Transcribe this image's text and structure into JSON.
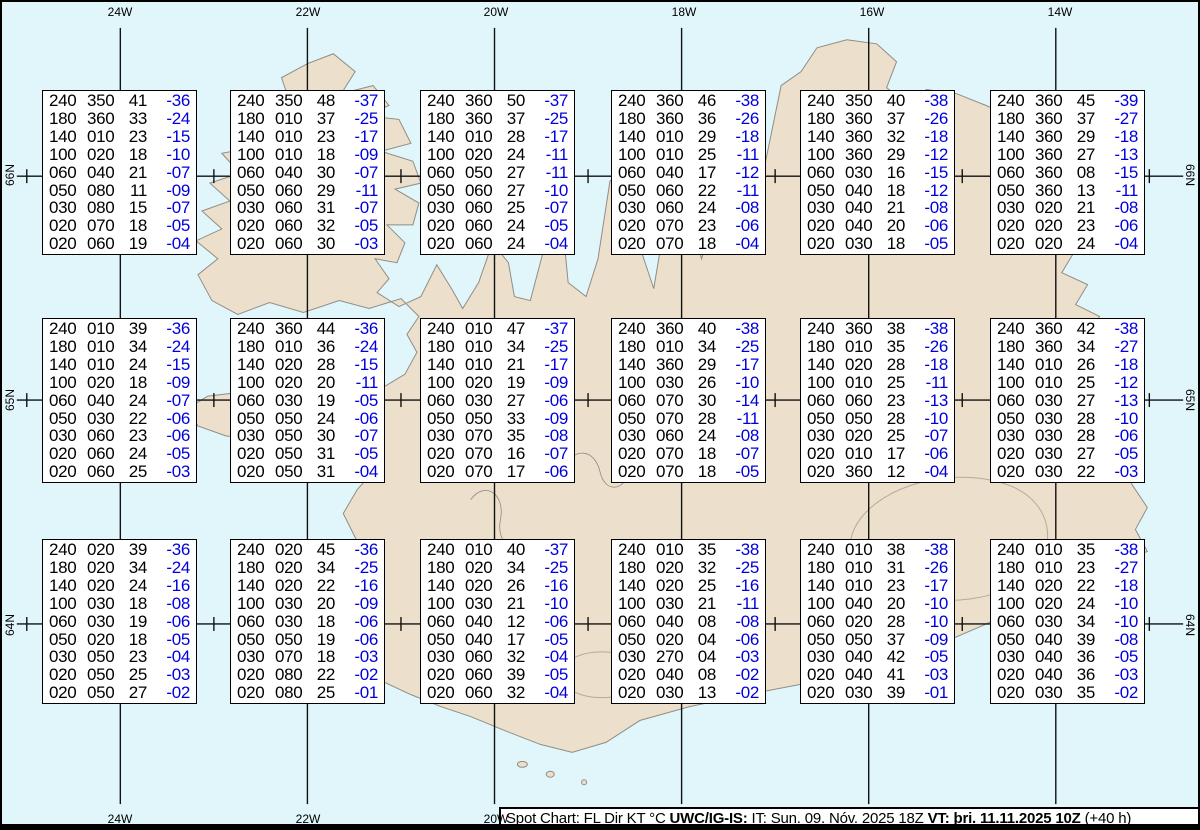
{
  "colors": {
    "ocean": "#e1f6fb",
    "land": "#ecdfcb",
    "coast": "#8f8d86",
    "glacier": "#b3ab9b",
    "temp": "#0000dd",
    "grid": "#111111",
    "boxborder": "#000000"
  },
  "grid": {
    "lon_labels": [
      "24W",
      "22W",
      "20W",
      "18W",
      "16W",
      "14W"
    ],
    "lon_x": [
      118,
      306,
      494,
      682,
      870,
      1058
    ],
    "bottom_labels_visible": 3,
    "lat_labels": [
      "66N",
      "65N",
      "64N"
    ],
    "lat_y": [
      175,
      400,
      625
    ],
    "tick_x": [
      24,
      212,
      400,
      588,
      776,
      964,
      1152
    ]
  },
  "caption": {
    "segments": [
      {
        "text": "Spot Chart: FL Dir KT °C ",
        "bold": false
      },
      {
        "text": "UWC/IG-IS:",
        "bold": true
      },
      {
        "text": " IT: Sun. 09. Nóv. 2025 18Z ",
        "bold": false
      },
      {
        "text": "VT: þri. 11.11.2025 10Z",
        "bold": true
      },
      {
        "text": " (+40 h)",
        "bold": false
      }
    ]
  },
  "columns": [
    "FL",
    "Dir",
    "KT",
    "°C"
  ],
  "layout": {
    "col_x": [
      40,
      228,
      418,
      609,
      798,
      988
    ],
    "row_y": [
      88,
      316,
      537
    ],
    "box_w": 155,
    "box_h": 165
  },
  "spot_boxes": [
    {
      "rows": [
        [
          "240",
          "350",
          "41",
          "-36"
        ],
        [
          "180",
          "360",
          "33",
          "-24"
        ],
        [
          "140",
          "010",
          "23",
          "-15"
        ],
        [
          "100",
          "020",
          "18",
          "-10"
        ],
        [
          "060",
          "040",
          "21",
          "-07"
        ],
        [
          "050",
          "080",
          "11",
          "-09"
        ],
        [
          "030",
          "080",
          "15",
          "-07"
        ],
        [
          "020",
          "070",
          "18",
          "-05"
        ],
        [
          "020",
          "060",
          "19",
          "-04"
        ]
      ]
    },
    {
      "rows": [
        [
          "240",
          "350",
          "48",
          "-37"
        ],
        [
          "180",
          "010",
          "37",
          "-25"
        ],
        [
          "140",
          "010",
          "23",
          "-17"
        ],
        [
          "100",
          "010",
          "18",
          "-09"
        ],
        [
          "060",
          "040",
          "30",
          "-07"
        ],
        [
          "050",
          "060",
          "29",
          "-11"
        ],
        [
          "030",
          "060",
          "31",
          "-07"
        ],
        [
          "020",
          "060",
          "32",
          "-05"
        ],
        [
          "020",
          "060",
          "30",
          "-03"
        ]
      ]
    },
    {
      "rows": [
        [
          "240",
          "360",
          "50",
          "-37"
        ],
        [
          "180",
          "360",
          "37",
          "-25"
        ],
        [
          "140",
          "010",
          "28",
          "-17"
        ],
        [
          "100",
          "020",
          "24",
          "-11"
        ],
        [
          "060",
          "050",
          "27",
          "-11"
        ],
        [
          "050",
          "060",
          "27",
          "-10"
        ],
        [
          "030",
          "060",
          "25",
          "-07"
        ],
        [
          "020",
          "060",
          "24",
          "-05"
        ],
        [
          "020",
          "060",
          "24",
          "-04"
        ]
      ]
    },
    {
      "rows": [
        [
          "240",
          "360",
          "46",
          "-38"
        ],
        [
          "180",
          "360",
          "36",
          "-26"
        ],
        [
          "140",
          "010",
          "29",
          "-18"
        ],
        [
          "100",
          "010",
          "25",
          "-11"
        ],
        [
          "060",
          "040",
          "17",
          "-12"
        ],
        [
          "050",
          "060",
          "22",
          "-11"
        ],
        [
          "030",
          "060",
          "24",
          "-08"
        ],
        [
          "020",
          "070",
          "23",
          "-06"
        ],
        [
          "020",
          "070",
          "18",
          "-04"
        ]
      ]
    },
    {
      "rows": [
        [
          "240",
          "350",
          "40",
          "-38"
        ],
        [
          "180",
          "360",
          "37",
          "-26"
        ],
        [
          "140",
          "360",
          "32",
          "-18"
        ],
        [
          "100",
          "360",
          "29",
          "-12"
        ],
        [
          "060",
          "030",
          "16",
          "-15"
        ],
        [
          "050",
          "040",
          "18",
          "-12"
        ],
        [
          "030",
          "040",
          "21",
          "-08"
        ],
        [
          "020",
          "040",
          "20",
          "-06"
        ],
        [
          "020",
          "030",
          "18",
          "-05"
        ]
      ]
    },
    {
      "rows": [
        [
          "240",
          "360",
          "45",
          "-39"
        ],
        [
          "180",
          "360",
          "37",
          "-27"
        ],
        [
          "140",
          "360",
          "29",
          "-18"
        ],
        [
          "100",
          "360",
          "27",
          "-13"
        ],
        [
          "060",
          "360",
          "08",
          "-15"
        ],
        [
          "050",
          "360",
          "13",
          "-11"
        ],
        [
          "030",
          "020",
          "21",
          "-08"
        ],
        [
          "020",
          "020",
          "23",
          "-06"
        ],
        [
          "020",
          "020",
          "24",
          "-04"
        ]
      ]
    },
    {
      "rows": [
        [
          "240",
          "010",
          "39",
          "-36"
        ],
        [
          "180",
          "010",
          "34",
          "-24"
        ],
        [
          "140",
          "010",
          "24",
          "-15"
        ],
        [
          "100",
          "020",
          "18",
          "-09"
        ],
        [
          "060",
          "040",
          "24",
          "-07"
        ],
        [
          "050",
          "030",
          "22",
          "-06"
        ],
        [
          "030",
          "060",
          "23",
          "-06"
        ],
        [
          "020",
          "060",
          "24",
          "-05"
        ],
        [
          "020",
          "060",
          "25",
          "-03"
        ]
      ]
    },
    {
      "rows": [
        [
          "240",
          "360",
          "44",
          "-36"
        ],
        [
          "180",
          "010",
          "36",
          "-24"
        ],
        [
          "140",
          "020",
          "28",
          "-15"
        ],
        [
          "100",
          "020",
          "20",
          "-11"
        ],
        [
          "060",
          "030",
          "19",
          "-05"
        ],
        [
          "050",
          "050",
          "24",
          "-06"
        ],
        [
          "030",
          "050",
          "30",
          "-07"
        ],
        [
          "020",
          "050",
          "31",
          "-05"
        ],
        [
          "020",
          "050",
          "31",
          "-04"
        ]
      ]
    },
    {
      "rows": [
        [
          "240",
          "010",
          "47",
          "-37"
        ],
        [
          "180",
          "010",
          "34",
          "-25"
        ],
        [
          "140",
          "010",
          "21",
          "-17"
        ],
        [
          "100",
          "020",
          "19",
          "-09"
        ],
        [
          "060",
          "030",
          "27",
          "-06"
        ],
        [
          "050",
          "050",
          "33",
          "-09"
        ],
        [
          "030",
          "070",
          "35",
          "-08"
        ],
        [
          "020",
          "070",
          "16",
          "-07"
        ],
        [
          "020",
          "070",
          "17",
          "-06"
        ]
      ]
    },
    {
      "rows": [
        [
          "240",
          "360",
          "40",
          "-38"
        ],
        [
          "180",
          "010",
          "34",
          "-25"
        ],
        [
          "140",
          "360",
          "29",
          "-17"
        ],
        [
          "100",
          "030",
          "26",
          "-10"
        ],
        [
          "060",
          "070",
          "30",
          "-14"
        ],
        [
          "050",
          "070",
          "28",
          "-11"
        ],
        [
          "030",
          "060",
          "24",
          "-08"
        ],
        [
          "020",
          "070",
          "18",
          "-07"
        ],
        [
          "020",
          "070",
          "18",
          "-05"
        ]
      ]
    },
    {
      "rows": [
        [
          "240",
          "360",
          "38",
          "-38"
        ],
        [
          "180",
          "010",
          "35",
          "-26"
        ],
        [
          "140",
          "020",
          "28",
          "-18"
        ],
        [
          "100",
          "010",
          "25",
          "-11"
        ],
        [
          "060",
          "060",
          "23",
          "-13"
        ],
        [
          "050",
          "050",
          "28",
          "-10"
        ],
        [
          "030",
          "020",
          "25",
          "-07"
        ],
        [
          "020",
          "010",
          "17",
          "-06"
        ],
        [
          "020",
          "360",
          "12",
          "-04"
        ]
      ]
    },
    {
      "rows": [
        [
          "240",
          "360",
          "42",
          "-38"
        ],
        [
          "180",
          "360",
          "34",
          "-27"
        ],
        [
          "140",
          "010",
          "26",
          "-18"
        ],
        [
          "100",
          "010",
          "25",
          "-12"
        ],
        [
          "060",
          "030",
          "27",
          "-13"
        ],
        [
          "050",
          "030",
          "28",
          "-10"
        ],
        [
          "030",
          "030",
          "28",
          "-06"
        ],
        [
          "020",
          "030",
          "27",
          "-05"
        ],
        [
          "020",
          "030",
          "22",
          "-03"
        ]
      ]
    },
    {
      "rows": [
        [
          "240",
          "020",
          "39",
          "-36"
        ],
        [
          "180",
          "020",
          "34",
          "-24"
        ],
        [
          "140",
          "020",
          "24",
          "-16"
        ],
        [
          "100",
          "030",
          "18",
          "-08"
        ],
        [
          "060",
          "030",
          "19",
          "-06"
        ],
        [
          "050",
          "020",
          "18",
          "-05"
        ],
        [
          "030",
          "050",
          "23",
          "-04"
        ],
        [
          "020",
          "050",
          "25",
          "-03"
        ],
        [
          "020",
          "050",
          "27",
          "-02"
        ]
      ]
    },
    {
      "rows": [
        [
          "240",
          "020",
          "45",
          "-36"
        ],
        [
          "180",
          "020",
          "34",
          "-25"
        ],
        [
          "140",
          "020",
          "22",
          "-16"
        ],
        [
          "100",
          "030",
          "20",
          "-09"
        ],
        [
          "060",
          "030",
          "18",
          "-06"
        ],
        [
          "050",
          "050",
          "19",
          "-06"
        ],
        [
          "030",
          "070",
          "18",
          "-03"
        ],
        [
          "020",
          "080",
          "22",
          "-02"
        ],
        [
          "020",
          "080",
          "25",
          "-01"
        ]
      ]
    },
    {
      "rows": [
        [
          "240",
          "010",
          "40",
          "-37"
        ],
        [
          "180",
          "020",
          "34",
          "-25"
        ],
        [
          "140",
          "020",
          "26",
          "-16"
        ],
        [
          "100",
          "030",
          "21",
          "-10"
        ],
        [
          "060",
          "040",
          "12",
          "-06"
        ],
        [
          "050",
          "040",
          "17",
          "-05"
        ],
        [
          "030",
          "060",
          "32",
          "-04"
        ],
        [
          "020",
          "060",
          "39",
          "-05"
        ],
        [
          "020",
          "060",
          "32",
          "-04"
        ]
      ]
    },
    {
      "rows": [
        [
          "240",
          "010",
          "35",
          "-38"
        ],
        [
          "180",
          "020",
          "32",
          "-25"
        ],
        [
          "140",
          "020",
          "25",
          "-16"
        ],
        [
          "100",
          "030",
          "21",
          "-11"
        ],
        [
          "060",
          "040",
          "08",
          "-08"
        ],
        [
          "050",
          "020",
          "04",
          "-06"
        ],
        [
          "030",
          "270",
          "04",
          "-03"
        ],
        [
          "020",
          "040",
          "08",
          "-02"
        ],
        [
          "020",
          "030",
          "13",
          "-02"
        ]
      ]
    },
    {
      "rows": [
        [
          "240",
          "010",
          "38",
          "-38"
        ],
        [
          "180",
          "010",
          "31",
          "-26"
        ],
        [
          "140",
          "010",
          "23",
          "-17"
        ],
        [
          "100",
          "040",
          "20",
          "-10"
        ],
        [
          "060",
          "020",
          "28",
          "-10"
        ],
        [
          "050",
          "050",
          "37",
          "-09"
        ],
        [
          "030",
          "040",
          "42",
          "-05"
        ],
        [
          "020",
          "040",
          "41",
          "-03"
        ],
        [
          "020",
          "030",
          "39",
          "-01"
        ]
      ]
    },
    {
      "rows": [
        [
          "240",
          "010",
          "35",
          "-38"
        ],
        [
          "180",
          "010",
          "23",
          "-27"
        ],
        [
          "140",
          "020",
          "22",
          "-18"
        ],
        [
          "100",
          "020",
          "24",
          "-10"
        ],
        [
          "060",
          "030",
          "34",
          "-10"
        ],
        [
          "050",
          "040",
          "39",
          "-08"
        ],
        [
          "030",
          "040",
          "36",
          "-05"
        ],
        [
          "020",
          "040",
          "36",
          "-03"
        ],
        [
          "020",
          "030",
          "35",
          "-02"
        ]
      ]
    }
  ]
}
